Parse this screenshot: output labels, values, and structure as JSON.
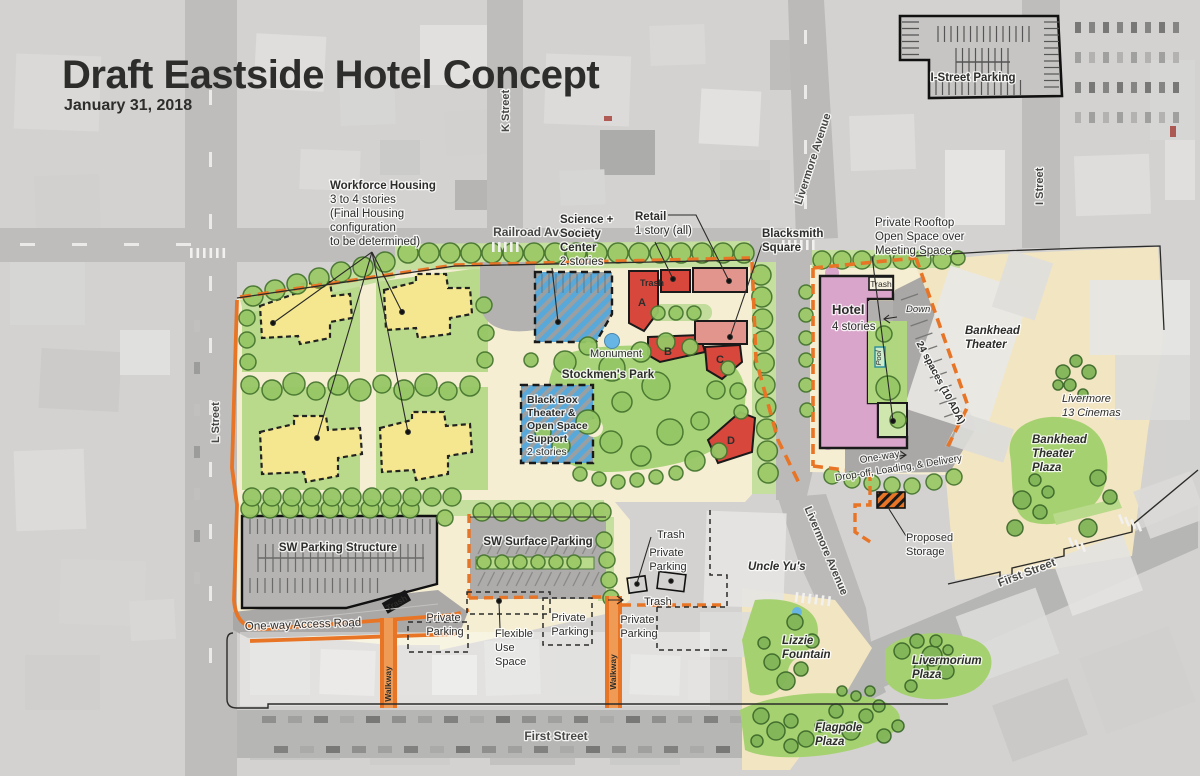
{
  "title": "Draft Eastside Hotel Concept",
  "date": "January 31, 2018",
  "colors": {
    "title_blue": "#1c5ba5",
    "date_red": "#c9232b",
    "boundary_orange": "#e87425",
    "housing_yellow": "#f5e78f",
    "retail_red": "#d8473c",
    "retail_light_red": "#e2958c",
    "hotel_pink": "#d9a5ca",
    "park_green": "#a8d378",
    "tree_green": "#9cc968",
    "plaza_tan": "#f2e5c2",
    "hatch_blue": "#58a8da",
    "water_blue": "#67b5e5"
  },
  "streets": {
    "railroad": "Railroad Avenue",
    "k": "K Street",
    "l": "L Street",
    "i": "I Street",
    "livermore": "Livermore Avenue",
    "first": "First Street"
  },
  "labels": {
    "i_street_parking": "I-Street Parking",
    "workforce": [
      "Workforce Housing",
      "3 to 4 stories",
      "(Final Housing",
      "configuration",
      "to be determined)"
    ],
    "science": [
      "Science +",
      "Society",
      "Center",
      "2 stories"
    ],
    "retail": [
      "Retail",
      "1 story (all)"
    ],
    "blacksmith": [
      "Blacksmith",
      "Square"
    ],
    "rooftop": [
      "Private Rooftop",
      "Open Space over",
      "Meeting Space"
    ],
    "hotel": [
      "Hotel",
      "4 stories"
    ],
    "blackbox": [
      "Black Box",
      "Theater &",
      "Open Space",
      "Support",
      "2 stories"
    ],
    "monument": "Monument",
    "stockmens": "Stockmen's Park",
    "spaces24": "24 spaces (10 ADA)",
    "one_way": "One-way",
    "drop_off": "Drop-off, Loading, & Delivery",
    "down": "Down",
    "pool": "Pool",
    "trash": "Trash",
    "bankhead": [
      "Bankhead",
      "Theater"
    ],
    "cinemas": [
      "Livermore",
      "13 Cinemas"
    ],
    "bankhead_plaza": [
      "Bankhead",
      "Theater",
      "Plaza"
    ],
    "sw_structure": "SW Parking Structure",
    "sw_surface": "SW Surface Parking",
    "private_parking": [
      "Private",
      "Parking"
    ],
    "flexible": [
      "Flexible",
      "Use",
      "Space"
    ],
    "access_road": "One-way Access Road",
    "walkway": "Walkway",
    "uncle": "Uncle Yu's",
    "storage": [
      "Proposed",
      "Storage"
    ],
    "lizzie": [
      "Lizzie",
      "Fountain"
    ],
    "livermorium": [
      "Livermorium",
      "Plaza"
    ],
    "flagpole": [
      "Flagpole",
      "Plaza"
    ],
    "bldg": {
      "a": "A",
      "b": "B",
      "c": "C",
      "d": "D"
    }
  }
}
